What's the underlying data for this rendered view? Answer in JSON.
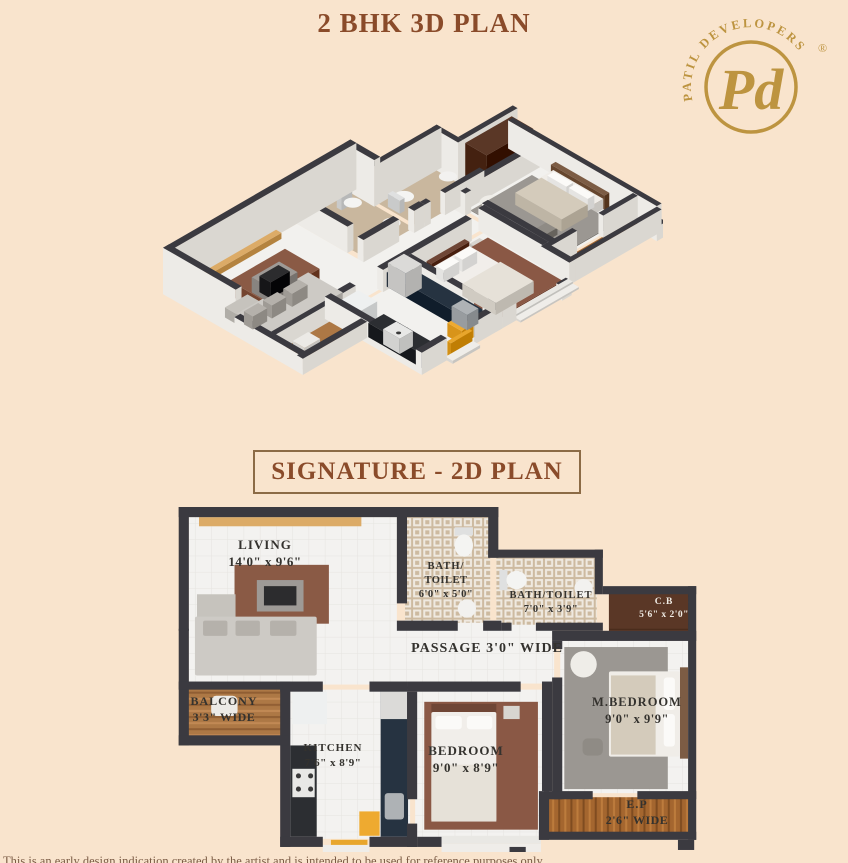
{
  "header": {
    "title_3d": "2 BHK 3D PLAN"
  },
  "logo": {
    "brand": "PATIL DEVELOPERS",
    "monogram": "Pd",
    "registered": "®",
    "color": "#bd9440"
  },
  "section2d": {
    "title": "SIGNATURE - 2D PLAN"
  },
  "footer": {
    "disclaimer": "This is an early design indication created by the artist and is intended to be used for reference purposes only"
  },
  "plan2d": {
    "rooms": {
      "living": {
        "name": "LIVING",
        "dim": "14'0\" x 9'6\""
      },
      "balcony": {
        "name": "BALCONY",
        "dim": "3'3\" WIDE"
      },
      "bath1": {
        "l1": "BATH/",
        "l2": "TOILET",
        "dim": "6'0\" x 5'0\""
      },
      "bath2": {
        "name": "BATH/TOILET",
        "dim": "7'0\" x 3'9\""
      },
      "cb": {
        "name": "C.B",
        "dim": "5'6\" x 2'0\""
      },
      "passage": {
        "name": "PASSAGE 3'0\" WIDE"
      },
      "kitchen": {
        "name": "KITCHEN",
        "dim": "7'6\" x 8'9\""
      },
      "bedroom": {
        "name": "BEDROOM",
        "dim": "9'0\" x 8'9\""
      },
      "mbedroom": {
        "name": "M.BEDROOM",
        "dim": "9'0\" x 9'9\""
      },
      "ep": {
        "name": "E.P",
        "dim": "2'6\" WIDE"
      }
    }
  },
  "colors": {
    "background": "#f9e4cd",
    "heading_brown": "#8a4b2a",
    "wall_dark": "#3b3a40",
    "gold": "#bd9440"
  },
  "plan_geometry": {
    "floors": [
      [
        10,
        10,
        205,
        165,
        "F"
      ],
      [
        108,
        112,
        262,
        62,
        "F"
      ],
      [
        108,
        180,
        120,
        147,
        "F"
      ],
      [
        233,
        180,
        127,
        147,
        "F"
      ],
      [
        376,
        130,
        128,
        152,
        "F"
      ],
      [
        223,
        8,
        84,
        106,
        "T"
      ],
      [
        313,
        48,
        99,
        68,
        "T"
      ],
      [
        424,
        84,
        80,
        40,
        "D"
      ],
      [
        8,
        178,
        94,
        49,
        "W"
      ],
      [
        363,
        286,
        141,
        36,
        "E"
      ]
    ],
    "walls": [
      [
        0,
        0,
        315,
        10,
        46
      ],
      [
        0,
        0,
        10,
        122,
        46
      ],
      [
        0,
        120,
        10,
        115,
        18
      ],
      [
        305,
        0,
        10,
        50,
        46
      ],
      [
        305,
        42,
        113,
        8,
        40
      ],
      [
        410,
        42,
        8,
        44,
        40
      ],
      [
        418,
        78,
        92,
        8,
        40
      ],
      [
        502,
        78,
        8,
        250,
        28
      ],
      [
        368,
        122,
        142,
        10,
        22
      ],
      [
        215,
        0,
        10,
        95,
        26
      ],
      [
        215,
        112,
        60,
        10,
        22
      ],
      [
        300,
        112,
        18,
        10,
        22
      ],
      [
        318,
        114,
        10,
        8,
        22
      ],
      [
        352,
        114,
        66,
        8,
        22
      ],
      [
        368,
        132,
        10,
        8,
        22
      ],
      [
        368,
        168,
        10,
        120,
        22
      ],
      [
        360,
        280,
        48,
        8,
        22
      ],
      [
        452,
        280,
        58,
        8,
        22
      ],
      [
        355,
        320,
        155,
        8,
        22
      ],
      [
        355,
        280,
        10,
        48,
        22
      ],
      [
        358,
        172,
        10,
        108,
        22
      ],
      [
        225,
        172,
        112,
        10,
        22
      ],
      [
        100,
        172,
        42,
        10,
        22
      ],
      [
        188,
        172,
        37,
        10,
        22
      ],
      [
        100,
        172,
        10,
        163,
        22
      ],
      [
        100,
        325,
        42,
        10,
        22
      ],
      [
        188,
        325,
        47,
        10,
        22
      ],
      [
        225,
        182,
        10,
        106,
        22
      ],
      [
        225,
        312,
        10,
        23,
        22
      ],
      [
        235,
        325,
        24,
        10,
        22
      ],
      [
        0,
        172,
        102,
        8,
        18
      ],
      [
        0,
        225,
        108,
        10,
        16
      ],
      [
        326,
        335,
        16,
        10,
        14
      ],
      [
        492,
        328,
        16,
        10,
        14
      ]
    ],
    "furniture": [
      [
        20,
        10,
        160,
        9,
        "#dcab67",
        6,
        1,
        0
      ],
      [
        55,
        57,
        93,
        58,
        "#8a5a45",
        14,
        1,
        0
      ],
      [
        77,
        72,
        46,
        31,
        "#9e9a96",
        15,
        2,
        0
      ],
      [
        84,
        78,
        32,
        19,
        "#2c2c2e",
        16,
        2,
        0
      ],
      [
        18,
        86,
        38,
        24,
        "#c6c3bd",
        10,
        1,
        0
      ],
      [
        16,
        108,
        120,
        58,
        "#cdcac5",
        12,
        1,
        2
      ],
      [
        24,
        112,
        24,
        15,
        "#b5b1ab",
        13,
        2,
        2
      ],
      [
        56,
        112,
        24,
        15,
        "#b5b1ab",
        13,
        2,
        2
      ],
      [
        90,
        112,
        26,
        15,
        "#b5b1ab",
        13,
        2,
        2
      ],
      [
        32,
        186,
        26,
        20,
        "#eceae6",
        6,
        1,
        5
      ],
      [
        272,
        20,
        18,
        8,
        "#dfe0e0",
        13,
        1,
        0
      ],
      [
        316,
        62,
        8,
        20,
        "#dfe0e0",
        13,
        1,
        0
      ],
      [
        112,
        182,
        34,
        32,
        "#eef0f0",
        16,
        1,
        0
      ],
      [
        110,
        235,
        26,
        90,
        "#2c2e32",
        14,
        1,
        0
      ],
      [
        112,
        258,
        22,
        28,
        "#e8e8e6",
        15,
        2,
        0
      ],
      [
        199,
        177,
        27,
        148,
        "#263341",
        14,
        1,
        0
      ],
      [
        199,
        179,
        27,
        30,
        "#dbdad8",
        24,
        2,
        0
      ],
      [
        203,
        282,
        19,
        26,
        "#aeb2b5",
        15,
        2,
        3
      ],
      [
        178,
        300,
        20,
        24,
        "#eeaa30",
        13,
        1,
        0
      ],
      [
        150,
        328,
        36,
        6,
        "#e8a62c",
        14,
        1,
        0
      ],
      [
        242,
        192,
        112,
        126,
        "#8a5845",
        1,
        1,
        0
      ],
      [
        249,
        194,
        64,
        8,
        "#6f4636",
        14,
        1,
        0
      ],
      [
        249,
        202,
        64,
        108,
        "#f1eeea",
        10,
        1,
        2
      ],
      [
        253,
        206,
        26,
        13,
        "#fbfaf8",
        12,
        2,
        3
      ],
      [
        284,
        206,
        25,
        13,
        "#fbfaf8",
        12,
        2,
        3
      ],
      [
        249,
        254,
        64,
        56,
        "#e6e1d8",
        12,
        2,
        0
      ],
      [
        320,
        196,
        16,
        13,
        "#d8d5d0",
        8,
        1,
        0
      ],
      [
        380,
        138,
        102,
        140,
        "#9b9792",
        1,
        1,
        0
      ],
      [
        494,
        158,
        8,
        90,
        "#7c5c44",
        14,
        1,
        0
      ],
      [
        424,
        162,
        70,
        84,
        "#f0ede8",
        10,
        1,
        2
      ],
      [
        478,
        168,
        11,
        32,
        "#fbfaf8",
        12,
        2,
        3
      ],
      [
        478,
        204,
        11,
        32,
        "#fbfaf8",
        12,
        2,
        3
      ],
      [
        426,
        166,
        44,
        78,
        "#d4cbbb",
        12,
        2,
        0
      ],
      [
        398,
        228,
        20,
        17,
        "#8f8b85",
        7,
        1,
        5
      ],
      [
        424,
        84,
        78,
        36,
        "#5a3726",
        34,
        1,
        0
      ],
      [
        259,
        324,
        98,
        8,
        "#e9e8e4",
        4,
        1,
        0
      ],
      [
        142,
        333,
        46,
        12,
        "#efede9",
        3,
        1,
        0
      ],
      [
        259,
        332,
        98,
        10,
        "#efede9",
        2,
        1,
        0
      ]
    ],
    "circles": [
      [
        284,
        100,
        9,
        "#f2f1ef",
        8,
        1
      ],
      [
        399,
        80,
        9,
        "#f2f1ef",
        8,
        1
      ],
      [
        399,
        155,
        13,
        "#efede8",
        8,
        1
      ],
      [
        118,
        265,
        2.5,
        "#3a3a3a",
        16,
        2
      ],
      [
        130,
        265,
        2.5,
        "#3a3a3a",
        16,
        2
      ],
      [
        118,
        278,
        2.5,
        "#3a3a3a",
        16,
        2
      ],
      [
        130,
        278,
        2.5,
        "#3a3a3a",
        16,
        2
      ]
    ],
    "ellipses": [
      [
        281,
        38,
        9,
        11,
        "#f4f4f2",
        8,
        1
      ],
      [
        333,
        72,
        10,
        9,
        "#f4f4f2",
        8,
        1
      ]
    ]
  }
}
